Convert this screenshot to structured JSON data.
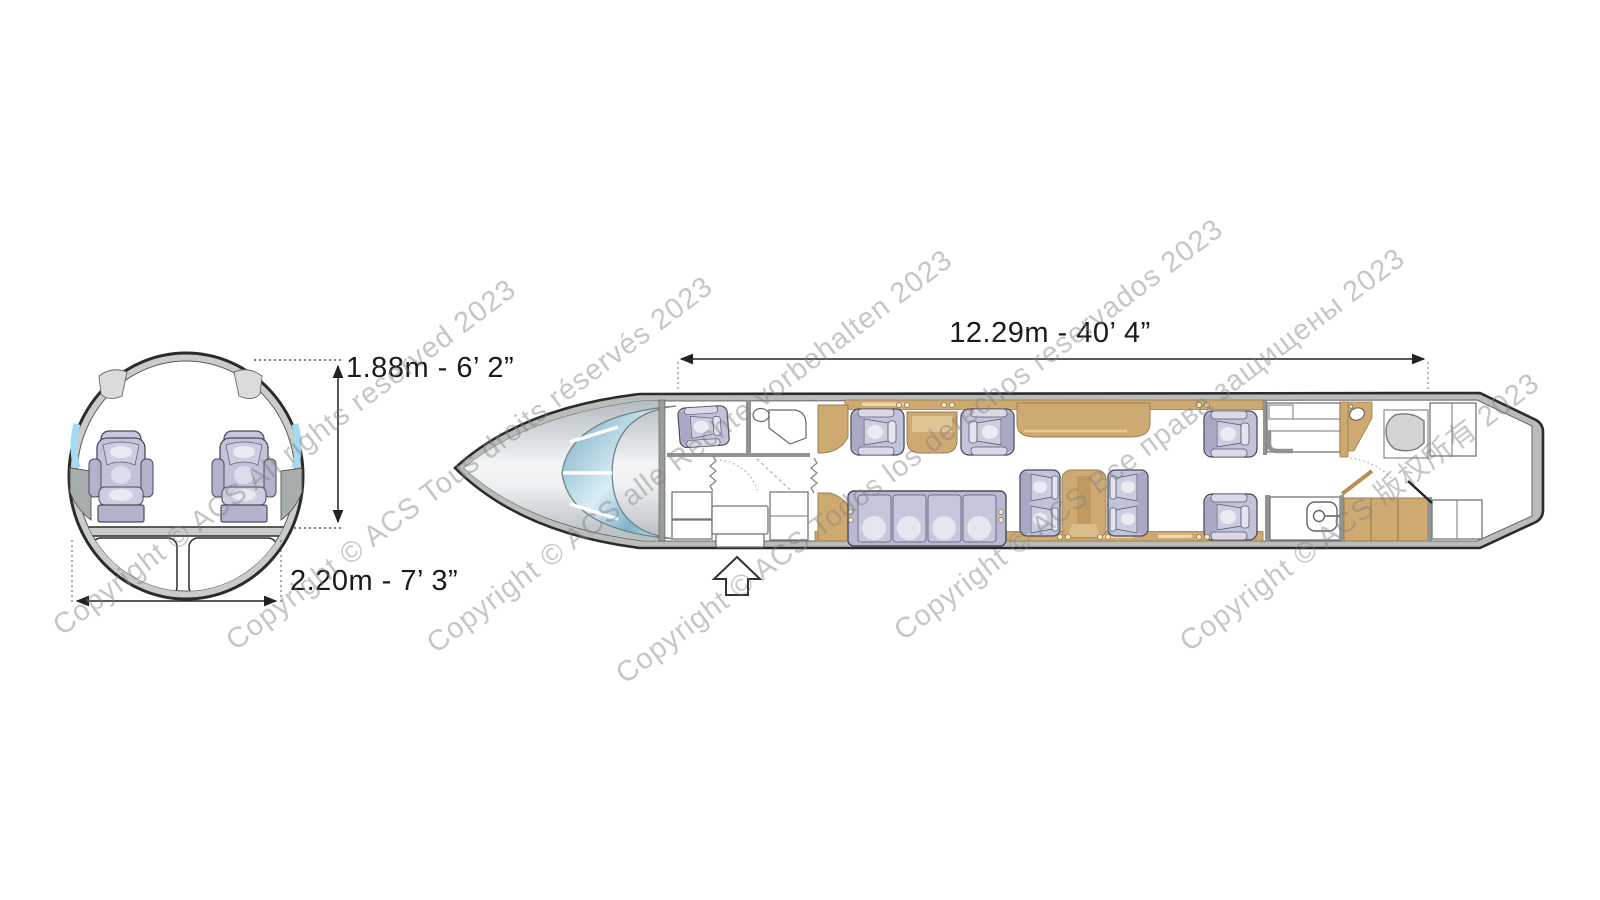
{
  "cross_section": {
    "height_label": "1.88m - 6’ 2”",
    "width_label": "2.20m - 7’ 3”"
  },
  "floor_plan": {
    "length_label": "12.29m - 40’ 4”"
  },
  "watermarks": [
    "Copyright © ACS All rights reserved 2023",
    "Copyright © ACS Tous droits réservés 2023",
    "Copyright © ACS alle Rechte vorbehalten 2023",
    "Copyright © ACS Todos los derechos reservados 2023",
    "Copyright © ACS Все права защищены 2023",
    "Copyright © ACS 版权所有 2023"
  ],
  "colors": {
    "outline": "#2b2b2b",
    "fuselage_wall": "#b9bdb9",
    "cabinetry_tan": "#cfa972",
    "cabinetry_tan_light": "#e3c795",
    "seat_lavender": "#c6c6dc",
    "window_blue": "#a5daf0",
    "windscreen_teal": "#7fb3c8",
    "watermark_gray": "#c2c2c2"
  }
}
